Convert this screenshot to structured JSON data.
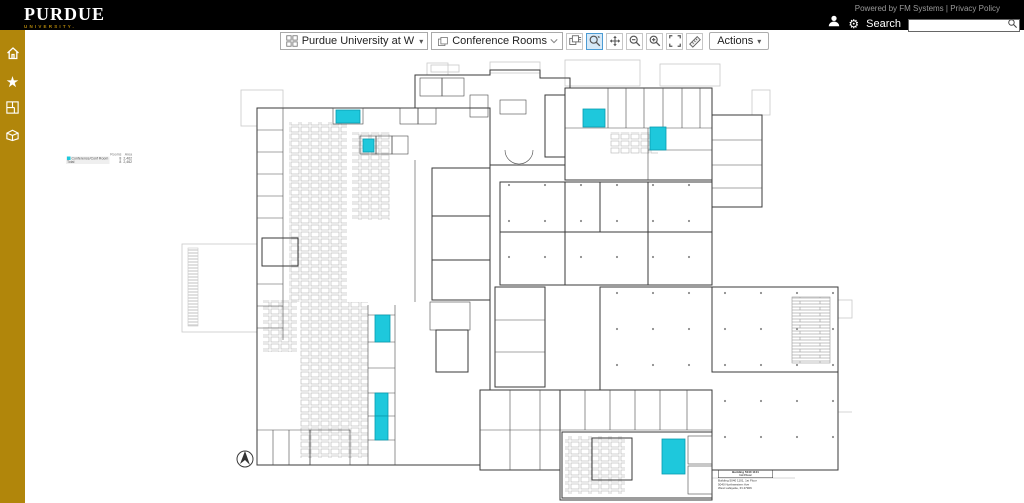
{
  "topbar": {
    "logo": {
      "primary": "PURDUE",
      "secondary": "UNIVERSITY."
    },
    "powered_by": "Powered by FM Systems | Privacy Policy",
    "search": {
      "label": "Search",
      "value": ""
    }
  },
  "toolbar": {
    "site_selector": "Purdue University at W",
    "view_selector": "Conference Rooms",
    "buttons": [
      {
        "icon": "report-icon",
        "active": false
      },
      {
        "icon": "zoom-window-icon",
        "active": true
      },
      {
        "icon": "pan-icon",
        "active": false
      },
      {
        "icon": "zoom-out-icon",
        "active": false
      },
      {
        "icon": "zoom-in-icon",
        "active": false
      },
      {
        "icon": "zoom-extents-icon",
        "active": false
      },
      {
        "icon": "measure-icon",
        "active": false
      }
    ],
    "actions_label": "Actions"
  },
  "sidebar": {
    "items": [
      {
        "name": "home",
        "icon": "home-icon"
      },
      {
        "name": "favorites",
        "icon": "star-icon"
      },
      {
        "name": "floorplans",
        "icon": "floorplan-icon"
      },
      {
        "name": "buildings",
        "icon": "building-icon"
      }
    ]
  },
  "legend": {
    "columns": [
      "Rooms",
      "Area"
    ],
    "rows": [
      {
        "label": "Conference/Conf Room",
        "rooms": "8",
        "area": "2,462",
        "swatch": "#1ec8dc"
      },
      {
        "label": "Total",
        "rooms": "8",
        "area": "2,462",
        "swatch": ""
      }
    ]
  },
  "floorplan": {
    "highlight_color": "#1ec8dc",
    "highlighted_rooms": [
      {
        "x": 336,
        "y": 110,
        "w": 24,
        "h": 13
      },
      {
        "x": 363,
        "y": 139,
        "w": 11,
        "h": 13
      },
      {
        "x": 583,
        "y": 109,
        "w": 22,
        "h": 18
      },
      {
        "x": 650,
        "y": 127,
        "w": 16,
        "h": 23
      },
      {
        "x": 375,
        "y": 315,
        "w": 15,
        "h": 27
      },
      {
        "x": 375,
        "y": 393,
        "w": 13,
        "h": 23
      },
      {
        "x": 375,
        "y": 416,
        "w": 13,
        "h": 24
      },
      {
        "x": 662,
        "y": 439,
        "w": 23,
        "h": 35
      }
    ],
    "title_block": {
      "box_line1": "Building 5040 1101",
      "box_line2": "1st Floor",
      "line1": "Building 5040 1101, 1st Floor",
      "line2": "5040 Northwestern Ave",
      "line3": "West Lafayette, IN 47906"
    }
  },
  "icons": {
    "caret_down": "▾",
    "gear": "⚙",
    "star": "★"
  },
  "colors": {
    "topbar_bg": "#000000",
    "sidebar_gold": "#b1860b",
    "highlight_cyan": "#1ec8dc",
    "active_tool_border": "#4c9cd4",
    "active_tool_bg": "#d6e9f8"
  }
}
